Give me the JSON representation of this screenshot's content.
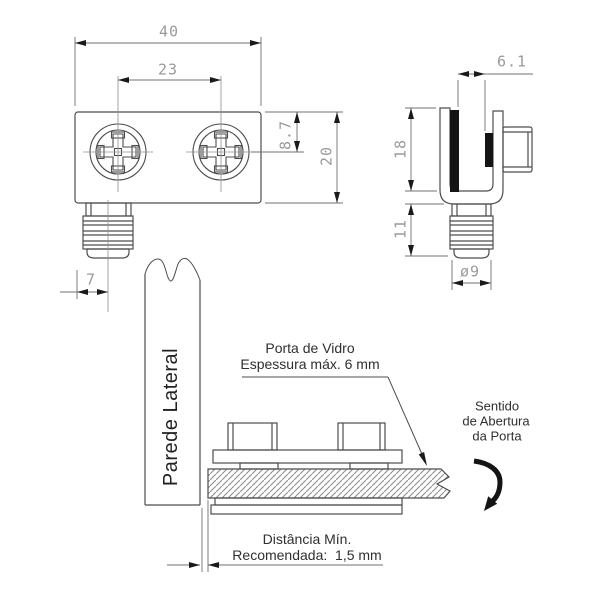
{
  "drawing_title": "glass-door-hinge-technical-drawing",
  "front_view": {
    "dim_width": "40",
    "dim_screw_spacing": "23",
    "dim_screw_center_offset": "8.7",
    "dim_height": "20",
    "dim_pin_offset": "7"
  },
  "side_view": {
    "dim_slot_width": "6.1",
    "dim_body_depth": "18",
    "dim_pin_length": "11",
    "dim_pin_diameter": "ø9"
  },
  "installation": {
    "wall_label": "Parede Lateral",
    "glass_note_line1": "Porta de Vidro",
    "glass_note_line2": "Espessura máx. 6 mm",
    "opening_line1": "Sentido",
    "opening_line2": "de Abertura",
    "opening_line3": "da Porta",
    "distance_line1": "Distância Mín.",
    "distance_line2": "Recomendada:  1,5 mm"
  },
  "colors": {
    "object_line": "#4d4d4d",
    "dim_line": "#707070",
    "centerline": "#909090",
    "dim_text": "#9a9a9a",
    "annotation_text": "#2f2f2f",
    "black_fill": "#141414",
    "hatch": "#8a8a8a",
    "background": "#ffffff"
  }
}
